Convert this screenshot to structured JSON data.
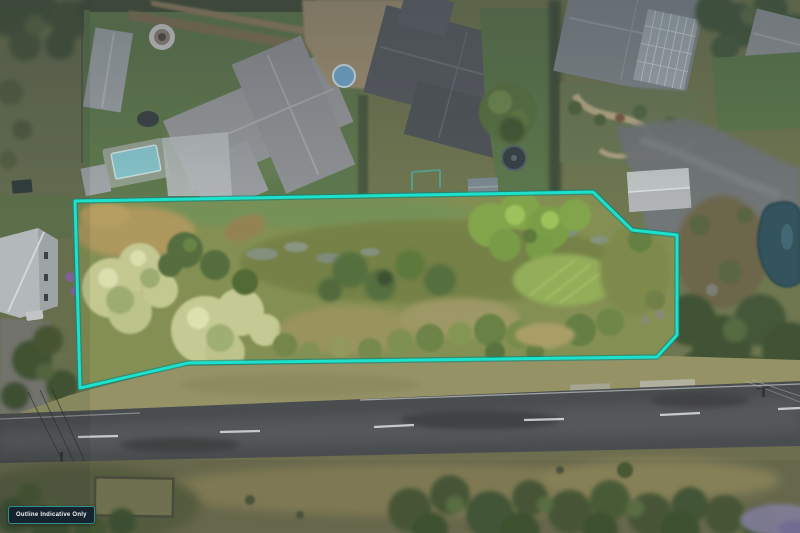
{
  "meta": {
    "kind": "aerial-drone-photograph",
    "description": "Top-down drone photo of a vacant scrub-and-tree covered land parcel outlined in turquoise, bordered by suburban backyards above, a two-lane road and paddock below, and a pond at right."
  },
  "overlay": {
    "boundary_points": "75,201 593,192 632,230 677,235 677,335 657,357 188,363 80,388",
    "outline_color": "#1ae2cd",
    "outline_halo_color": "#0a837c"
  },
  "badge": {
    "label": "Outline Indicative Only",
    "background": "#16232e",
    "border_color": "#2e8f8d",
    "text_color": "#f4f7f8"
  }
}
